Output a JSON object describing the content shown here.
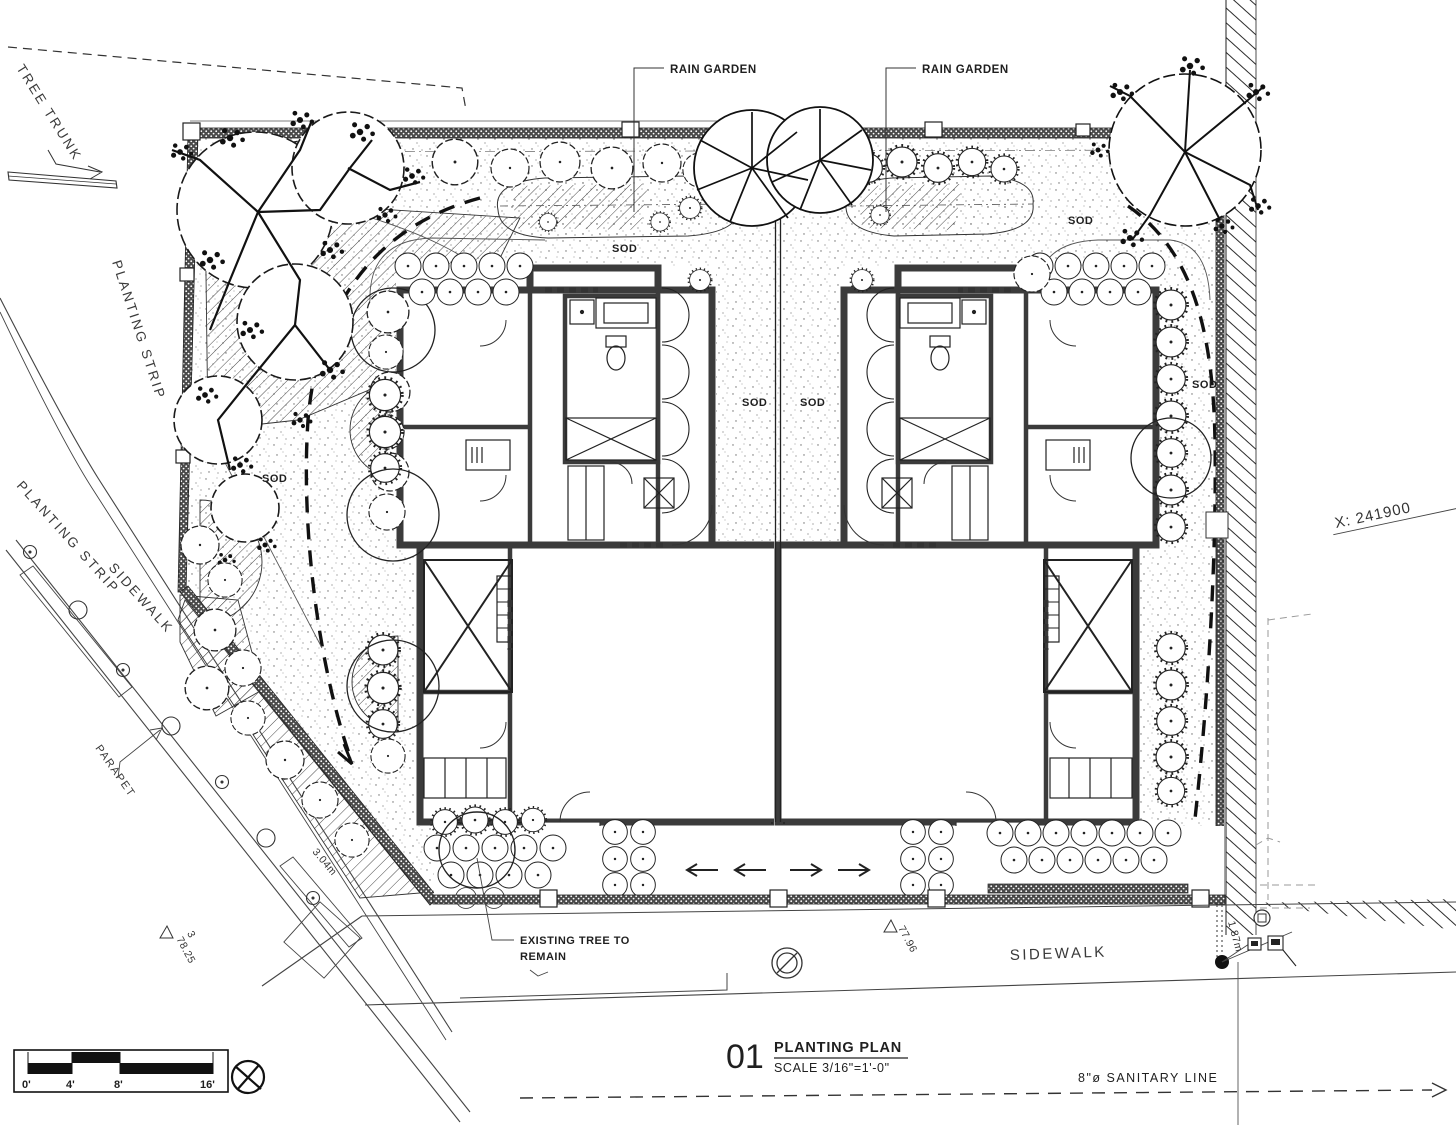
{
  "drawing": {
    "type": "architectural planting plan",
    "labels": {
      "rain_garden": "RAIN GARDEN",
      "sod": "SOD",
      "tree_trunk": "TREE TRUNK",
      "planting_strip": "PLANTING STRIP",
      "sidewalk": "SIDEWALK",
      "parapet": "PARAPET",
      "existing_tree_line1": "EXISTING TREE TO",
      "existing_tree_line2": "REMAIN",
      "coord_x": "X: 241900",
      "sanitary_line": "8\"ø  SANITARY  LINE"
    },
    "dimensions": {
      "elev_a": "77.96",
      "elev_b": "78.25",
      "elev_b_index": "3",
      "dim_a": "3.04m",
      "dim_b": "1.87m"
    },
    "title_block": {
      "number": "01",
      "title": "PLANTING PLAN",
      "scale": "SCALE 3/16\"=1'-0\""
    },
    "scale_bar": {
      "ticks": [
        "0'",
        "4'",
        "8'",
        "16'"
      ]
    },
    "colors": {
      "ink": "#1f1f1f",
      "wall": "#3b3b3b",
      "paper": "#ffffff"
    }
  }
}
